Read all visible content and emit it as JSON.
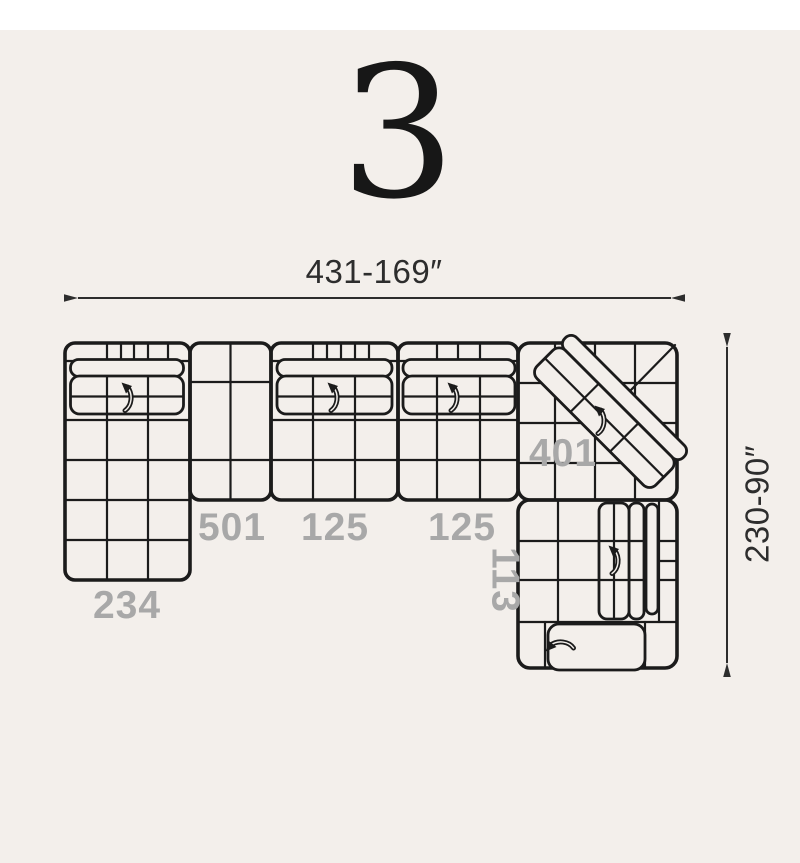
{
  "page": {
    "title": "3",
    "background_color": "#f3efeb",
    "top_strip_color": "#ffffff",
    "line_color": "#1b1b1b",
    "label_color": "#a8a8a8",
    "dimension_text_color": "#2d2d2d"
  },
  "dimensions": {
    "width_label": "431-169″",
    "height_label": "230-90″"
  },
  "modules": [
    {
      "id": "chaise-left",
      "label": "234"
    },
    {
      "id": "armless-unit",
      "label": "501"
    },
    {
      "id": "seat-unit-1",
      "label": "125"
    },
    {
      "id": "seat-unit-2",
      "label": "125"
    },
    {
      "id": "corner-unit",
      "label": "401"
    },
    {
      "id": "seat-unit-right",
      "label": "113"
    }
  ],
  "icons": {
    "recliner_arrow": "curved-arrow"
  }
}
